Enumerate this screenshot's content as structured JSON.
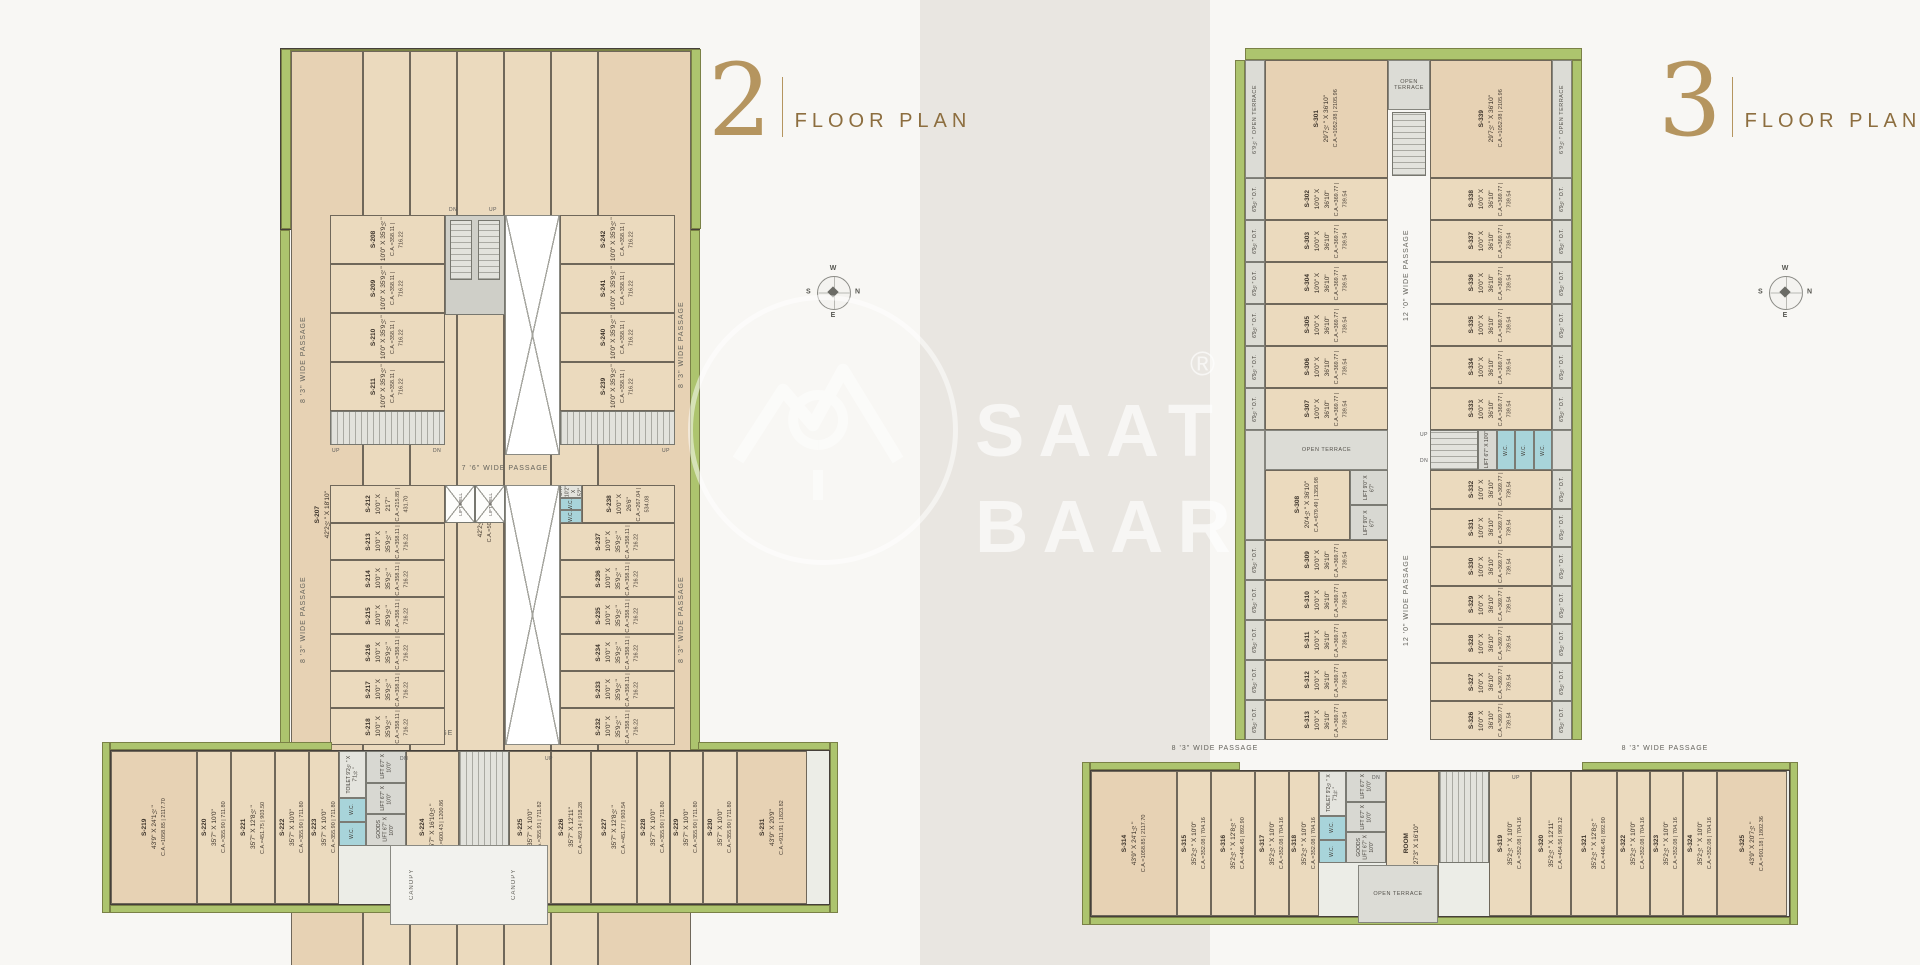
{
  "watermark": {
    "line1": "SAAT",
    "line2": "BAAR",
    "reg": "®"
  },
  "compass": {
    "top": "W",
    "right": "N",
    "bottom": "E",
    "left": "S"
  },
  "labels": {
    "lift_well": "LIFT WELL",
    "wc": "W.C.",
    "toilet": "TOILET 9'2½\" X 7'1½\"",
    "lift": "LIFT 6'7\" X 10'0\"",
    "goods_lift": "GOODS LIFT 6'7\" X 10'0\"",
    "canopy": "CANOPY",
    "ot_small": "O.T. 10'2\" X 5'2\"",
    "up": "UP",
    "dn": "DN"
  },
  "plan2": {
    "title_number": "2",
    "title_label": "FLOOR PLAN",
    "passages": {
      "top": "8 '3\" WIDE PASSAGE",
      "mid": "7 '6\" WIDE PASSAGE",
      "left_upper": "8 '3\" WIDE PASSAGE",
      "left_lower": "8 '3\" WIDE PASSAGE",
      "right_upper": "8 '3\" WIDE PASSAGE",
      "right_lower": "8 '3\" WIDE PASSAGE",
      "bottom_left": "8 '3\" WIDE PASSAGE",
      "bottom_right": "8 '3\" WIDE PASSAGE"
    },
    "top_row": [
      {
        "id": "S-207",
        "dim": "42'2½\" X 18'10\"",
        "ca": "C.A.=795.57 | 1591.14",
        "w": 72,
        "big": true
      },
      {
        "id": "S-206",
        "dim": "42'2½\" X 12'0\"",
        "ca": "C.A.=506.65 | 1013.29",
        "w": 47
      },
      {
        "id": "S-205",
        "dim": "42'2½\" X 12'0\"",
        "ca": "C.A.=506.65 | 1013.29",
        "w": 47
      },
      {
        "id": "S-204",
        "dim": "42'2½\" X 12'0\"",
        "ca": "C.A.=506.65 | 1013.29",
        "w": 47
      },
      {
        "id": "S-203",
        "dim": "42'2½\" X 12'0\"",
        "ca": "C.A.=506.65 | 1013.29",
        "w": 47
      },
      {
        "id": "S-202",
        "dim": "42'2½\" X 12'0\"",
        "ca": "C.A.=506.65 | 1013.29",
        "w": 47
      },
      {
        "id": "S-201",
        "dim": "42'2½\" X 18'10\"",
        "ca": "C.A.=795.57 | 1591.14",
        "w": 93,
        "big": true
      }
    ],
    "mid_left_upper": [
      {
        "id": "S-208",
        "dim": "10'0\" X 35'9½\"",
        "ca": "C.A.=358.11 | 716.22"
      },
      {
        "id": "S-209",
        "dim": "10'0\" X 35'9½\"",
        "ca": "C.A.=358.11 | 716.22"
      },
      {
        "id": "S-210",
        "dim": "10'0\" X 35'9½\"",
        "ca": "C.A.=358.11 | 716.22"
      },
      {
        "id": "S-211",
        "dim": "10'0\" X 35'9½\"",
        "ca": "C.A.=358.11 | 716.22"
      }
    ],
    "mid_right_upper": [
      {
        "id": "S-242",
        "dim": "10'0\" X 35'9½\"",
        "ca": "C.A.=358.11 | 716.22"
      },
      {
        "id": "S-241",
        "dim": "10'0\" X 35'9½\"",
        "ca": "C.A.=358.11 | 716.22"
      },
      {
        "id": "S-240",
        "dim": "10'0\" X 35'9½\"",
        "ca": "C.A.=358.11 | 716.22"
      },
      {
        "id": "S-239",
        "dim": "10'0\" X 35'9½\"",
        "ca": "C.A.=358.11 | 716.22"
      }
    ],
    "s212": {
      "id": "S-212",
      "dim": "10'0\" X 21'7\"",
      "ca": "C.A.=215.85 | 431.70"
    },
    "mid_left_lower": [
      {
        "id": "S-213",
        "dim": "10'0\" X 35'9½\"",
        "ca": "C.A.=358.11 | 716.22"
      },
      {
        "id": "S-214",
        "dim": "10'0\" X 35'9½\"",
        "ca": "C.A.=358.11 | 716.22"
      },
      {
        "id": "S-215",
        "dim": "10'0\" X 35'9½\"",
        "ca": "C.A.=358.11 | 716.22"
      },
      {
        "id": "S-216",
        "dim": "10'0\" X 35'9½\"",
        "ca": "C.A.=358.11 | 716.22"
      },
      {
        "id": "S-217",
        "dim": "10'0\" X 35'9½\"",
        "ca": "C.A.=358.11 | 716.22"
      },
      {
        "id": "S-218",
        "dim": "10'0\" X 35'9½\"",
        "ca": "C.A.=358.11 | 716.22"
      }
    ],
    "s238": {
      "id": "S-238",
      "dim": "10'0\" X 26'6\"",
      "ca": "C.A.=267.04 | 534.08"
    },
    "mid_right_lower": [
      {
        "id": "S-237",
        "dim": "10'0\" X 35'9½\"",
        "ca": "C.A.=358.11 | 716.22"
      },
      {
        "id": "S-236",
        "dim": "10'0\" X 35'9½\"",
        "ca": "C.A.=358.11 | 716.22"
      },
      {
        "id": "S-235",
        "dim": "10'0\" X 35'9½\"",
        "ca": "C.A.=358.11 | 716.22"
      },
      {
        "id": "S-234",
        "dim": "10'0\" X 35'9½\"",
        "ca": "C.A.=358.11 | 716.22"
      },
      {
        "id": "S-233",
        "dim": "10'0\" X 35'9½\"",
        "ca": "C.A.=358.11 | 716.22"
      },
      {
        "id": "S-232",
        "dim": "10'0\" X 35'9½\"",
        "ca": "C.A.=358.11 | 716.22"
      }
    ],
    "bottom_left": [
      {
        "id": "S-219",
        "dim": "43'9\" X 24'1½\"",
        "ca": "C.A.=1058.85 | 2117.70",
        "w": 86,
        "big": true
      },
      {
        "id": "S-220",
        "dim": "35'7\" X 10'0\"",
        "ca": "C.A.=355.90 | 711.80",
        "w": 34
      },
      {
        "id": "S-221",
        "dim": "35'7\" X 12'8½\"",
        "ca": "C.A.=451.75 | 903.50",
        "w": 44
      },
      {
        "id": "S-222",
        "dim": "35'7\" X 10'0\"",
        "ca": "C.A.=355.90 | 711.80",
        "w": 34
      },
      {
        "id": "S-223",
        "dim": "35'7\" X 10'0\"",
        "ca": "C.A.=355.90 | 711.80",
        "w": 30
      }
    ],
    "s224": {
      "id": "S-224",
      "dim": "35'7\" X 16'10½\"",
      "ca": "C.A.=600.43 | 1200.86"
    },
    "bottom_right": [
      {
        "id": "S-225",
        "dim": "35'7\" X 10'0\"",
        "ca": "C.A.=355.91 | 711.82",
        "w": 42
      },
      {
        "id": "S-226",
        "dim": "35'7\" X 12'11\"",
        "ca": "C.A.=459.14 | 918.28",
        "w": 40
      },
      {
        "id": "S-227",
        "dim": "35'7\" X 12'8½\"",
        "ca": "C.A.=451.77 | 903.54",
        "w": 46
      },
      {
        "id": "S-228",
        "dim": "35'7\" X 10'0\"",
        "ca": "C.A.=355.90 | 711.80",
        "w": 33
      },
      {
        "id": "S-229",
        "dim": "35'7\" X 10'0\"",
        "ca": "C.A.=355.90 | 711.80",
        "w": 33
      },
      {
        "id": "S-230",
        "dim": "35'7\" X 10'0\"",
        "ca": "C.A.=355.90 | 711.80",
        "w": 34
      },
      {
        "id": "S-231",
        "dim": "43'9\" X 20'9\"",
        "ca": "C.A.=911.91 | 1823.82",
        "w": 70,
        "big": true
      }
    ]
  },
  "plan3": {
    "title_number": "3",
    "title_label": "FLOOR PLAN",
    "passages": {
      "center_upper": "12 '0\" WIDE PASSAGE",
      "center_lower": "12 '0\" WIDE PASSAGE",
      "bottom_left": "8 '3\" WIDE PASSAGE",
      "bottom_right": "8 '3\" WIDE PASSAGE"
    },
    "open_terrace": "OPEN TERRACE",
    "ot_strip": "6'9½\" OPEN TERRACE",
    "lift9": "LIFT 9'0\" X 6'7\"",
    "room_core": {
      "id": "ROOM",
      "dim": "27'3\" X 16'10\"",
      "ca": ""
    },
    "s301": {
      "id": "S-301",
      "dim": "29'7½\" X 36'10\"",
      "ca": "C.A.=1052.98 | 2105.96"
    },
    "s339": {
      "id": "S-339",
      "dim": "29'7½\" X 36'10\"",
      "ca": "C.A.=1052.98 | 2105.96"
    },
    "s308": {
      "id": "S-308",
      "dim": "20'4½\" X 36'10\"",
      "ca": "C.A.=679.49 | 1358.98"
    },
    "left_upper": [
      {
        "id": "S-302",
        "dim": "10'0\" X 36'10\"",
        "ca": "C.A.=369.77 | 739.54"
      },
      {
        "id": "S-303",
        "dim": "10'0\" X 36'10\"",
        "ca": "C.A.=369.77 | 739.54"
      },
      {
        "id": "S-304",
        "dim": "10'0\" X 36'10\"",
        "ca": "C.A.=369.77 | 739.54"
      },
      {
        "id": "S-305",
        "dim": "10'0\" X 36'10\"",
        "ca": "C.A.=369.77 | 739.54"
      },
      {
        "id": "S-306",
        "dim": "10'0\" X 36'10\"",
        "ca": "C.A.=369.77 | 739.54"
      },
      {
        "id": "S-307",
        "dim": "10'0\" X 36'10\"",
        "ca": "C.A.=369.77 | 739.54"
      }
    ],
    "right_upper": [
      {
        "id": "S-338",
        "dim": "10'0\" X 36'10\"",
        "ca": "C.A.=369.77 | 739.54"
      },
      {
        "id": "S-337",
        "dim": "10'0\" X 36'10\"",
        "ca": "C.A.=369.77 | 739.54"
      },
      {
        "id": "S-336",
        "dim": "10'0\" X 36'10\"",
        "ca": "C.A.=369.77 | 739.54"
      },
      {
        "id": "S-335",
        "dim": "10'0\" X 36'10\"",
        "ca": "C.A.=369.77 | 739.54"
      },
      {
        "id": "S-334",
        "dim": "10'0\" X 36'10\"",
        "ca": "C.A.=369.77 | 739.54"
      },
      {
        "id": "S-333",
        "dim": "10'0\" X 36'10\"",
        "ca": "C.A.=369.77 | 739.54"
      }
    ],
    "left_lower": [
      {
        "id": "S-309",
        "dim": "10'0\" X 36'10\"",
        "ca": "C.A.=369.77 | 739.54"
      },
      {
        "id": "S-310",
        "dim": "10'0\" X 36'10\"",
        "ca": "C.A.=369.77 | 739.54"
      },
      {
        "id": "S-311",
        "dim": "10'0\" X 36'10\"",
        "ca": "C.A.=369.77 | 739.54"
      },
      {
        "id": "S-312",
        "dim": "10'0\" X 36'10\"",
        "ca": "C.A.=369.77 | 739.54"
      },
      {
        "id": "S-313",
        "dim": "10'0\" X 36'10\"",
        "ca": "C.A.=369.77 | 739.54"
      }
    ],
    "right_lower": [
      {
        "id": "S-332",
        "dim": "10'0\" X 36'10\"",
        "ca": "C.A.=369.77 | 739.54"
      },
      {
        "id": "S-331",
        "dim": "10'0\" X 36'10\"",
        "ca": "C.A.=369.77 | 739.54"
      },
      {
        "id": "S-330",
        "dim": "10'0\" X 36'10\"",
        "ca": "C.A.=369.77 | 739.54"
      },
      {
        "id": "S-329",
        "dim": "10'0\" X 36'10\"",
        "ca": "C.A.=369.77 | 739.54"
      },
      {
        "id": "S-328",
        "dim": "10'0\" X 36'10\"",
        "ca": "C.A.=369.77 | 739.54"
      },
      {
        "id": "S-327",
        "dim": "10'0\" X 36'10\"",
        "ca": "C.A.=369.77 | 739.54"
      },
      {
        "id": "S-326",
        "dim": "10'0\" X 36'10\"",
        "ca": "C.A.=369.77 | 739.54"
      }
    ],
    "ot_cells_left_upper": [
      "6'9½\" O.T.",
      "6'9½\" O.T.",
      "6'9½\" O.T.",
      "6'9½\" O.T.",
      "6'9½\" O.T.",
      "6'9½\" O.T."
    ],
    "ot_cells_left_lower": [
      "6'9½\" O.T.",
      "6'9½\" O.T.",
      "6'9½\" O.T.",
      "6'9½\" O.T.",
      "6'9½\" O.T."
    ],
    "ot_cells_right_upper": [
      "6'9½\" O.T.",
      "6'9½\" O.T.",
      "6'9½\" O.T.",
      "6'9½\" O.T.",
      "6'9½\" O.T.",
      "6'9½\" O.T."
    ],
    "ot_cells_right_lower": [
      "6'9½\" O.T.",
      "6'9½\" O.T.",
      "6'9½\" O.T.",
      "6'9½\" O.T.",
      "6'9½\" O.T.",
      "6'9½\" O.T.",
      "6'9½\" O.T."
    ],
    "bottom_left": [
      {
        "id": "S-314",
        "dim": "43'9\" X 24'1½\"",
        "ca": "C.A.=1058.85 | 2117.70",
        "w": 86,
        "big": true
      },
      {
        "id": "S-315",
        "dim": "35'2½\" X 10'0\"",
        "ca": "C.A.=352.08 | 704.16",
        "w": 34
      },
      {
        "id": "S-316",
        "dim": "35'2½\" X 12'8½\"",
        "ca": "C.A.=446.45 | 892.90",
        "w": 44
      },
      {
        "id": "S-317",
        "dim": "35'2½\" X 10'0\"",
        "ca": "C.A.=352.08 | 704.16",
        "w": 34
      },
      {
        "id": "S-318",
        "dim": "35'2½\" X 10'0\"",
        "ca": "C.A.=352.08 | 704.16",
        "w": 30
      }
    ],
    "bottom_right": [
      {
        "id": "S-319",
        "dim": "35'2½\" X 10'0\"",
        "ca": "C.A.=352.08 | 704.16",
        "w": 42
      },
      {
        "id": "S-320",
        "dim": "35'2½\" X 12'11\"",
        "ca": "C.A.=454.56 | 909.12",
        "w": 40
      },
      {
        "id": "S-321",
        "dim": "35'2½\" X 12'8½\"",
        "ca": "C.A.=446.45 | 892.90",
        "w": 46
      },
      {
        "id": "S-322",
        "dim": "35'2½\" X 10'0\"",
        "ca": "C.A.=352.08 | 704.16",
        "w": 33
      },
      {
        "id": "S-323",
        "dim": "35'2½\" X 10'0\"",
        "ca": "C.A.=352.08 | 704.16",
        "w": 33
      },
      {
        "id": "S-324",
        "dim": "35'2½\" X 10'0\"",
        "ca": "C.A.=352.08 | 704.16",
        "w": 34
      },
      {
        "id": "S-325",
        "dim": "43'9\" X 20'7½\"",
        "ca": "C.A.=901.18 | 1802.36",
        "w": 70,
        "big": true
      }
    ]
  }
}
